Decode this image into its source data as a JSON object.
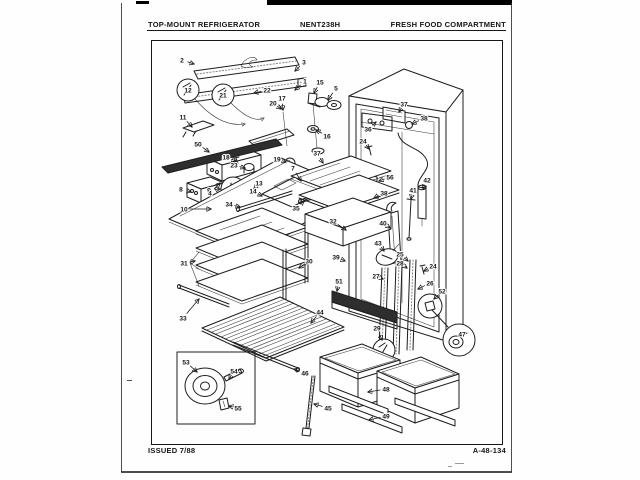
{
  "page": {
    "paper_color": "#fefefe",
    "ink_color": "#1d1d1d"
  },
  "header": {
    "left": "TOP-MOUNT REFRIGERATOR",
    "center": "NENT238H",
    "right": "FRESH FOOD COMPARTMENT"
  },
  "footer": {
    "left": "ISSUED 7/88",
    "right": "A-48-134"
  },
  "diagram": {
    "description": "exploded-parts-view-fresh-food-compartment",
    "callouts": [
      {
        "n": "2",
        "x": 182,
        "y": 60,
        "tx": 194,
        "ty": 64
      },
      {
        "n": "3",
        "x": 304,
        "y": 62,
        "tx": 295,
        "ty": 71
      },
      {
        "n": "1",
        "x": 305,
        "y": 81,
        "tx": 295,
        "ty": 90
      },
      {
        "n": "15",
        "x": 320,
        "y": 82,
        "tx": 314,
        "ty": 93
      },
      {
        "n": "5",
        "x": 336,
        "y": 88,
        "tx": 328,
        "ty": 100
      },
      {
        "n": "12",
        "x": 188,
        "y": 90
      },
      {
        "n": "21",
        "x": 223,
        "y": 95
      },
      {
        "n": "22",
        "x": 267,
        "y": 90,
        "tx": 254,
        "ty": 93
      },
      {
        "n": "17",
        "x": 282,
        "y": 98,
        "tx": 283,
        "ty": 110
      },
      {
        "n": "20",
        "x": 273,
        "y": 103,
        "tx": 281,
        "ty": 109
      },
      {
        "n": "11",
        "x": 183,
        "y": 117,
        "tx": 192,
        "ty": 127
      },
      {
        "n": "16",
        "x": 327,
        "y": 136,
        "tx": 316,
        "ty": 130
      },
      {
        "n": "36",
        "x": 368,
        "y": 129,
        "tx": 376,
        "ty": 122
      },
      {
        "n": "37",
        "x": 404,
        "y": 104,
        "tx": 399,
        "ty": 112
      },
      {
        "n": "38",
        "x": 424,
        "y": 118,
        "tx": 412,
        "ty": 124
      },
      {
        "n": "24",
        "x": 363,
        "y": 141,
        "tx": 369,
        "ty": 149
      },
      {
        "n": "50",
        "x": 198,
        "y": 144,
        "tx": 209,
        "ty": 152
      },
      {
        "n": "37",
        "x": 317,
        "y": 153,
        "tx": 323,
        "ty": 163
      },
      {
        "n": "18",
        "x": 226,
        "y": 157,
        "tx": 236,
        "ty": 161
      },
      {
        "n": "19",
        "x": 277,
        "y": 159,
        "tx": 286,
        "ty": 162
      },
      {
        "n": "23",
        "x": 234,
        "y": 165,
        "tx": 245,
        "ty": 168
      },
      {
        "n": "7",
        "x": 293,
        "y": 168,
        "tx": 301,
        "ty": 181
      },
      {
        "n": "56",
        "x": 390,
        "y": 177,
        "tx": 379,
        "ty": 181
      },
      {
        "n": "42",
        "x": 427,
        "y": 180,
        "tx": 423,
        "ty": 189
      },
      {
        "n": "13",
        "x": 259,
        "y": 183,
        "tx": 254,
        "ty": 189
      },
      {
        "n": "8",
        "x": 181,
        "y": 189,
        "tx": 191,
        "ty": 192
      },
      {
        "n": "9",
        "x": 209,
        "y": 190,
        "tx": 220,
        "ty": 189
      },
      {
        "n": "41",
        "x": 413,
        "y": 190,
        "tx": 411,
        "ty": 199
      },
      {
        "n": "14",
        "x": 253,
        "y": 191,
        "tx": 262,
        "ty": 196
      },
      {
        "n": "4",
        "x": 210,
        "y": 193,
        "tx": 220,
        "ty": 183
      },
      {
        "n": "38",
        "x": 384,
        "y": 193,
        "tx": 374,
        "ty": 198
      },
      {
        "n": "34",
        "x": 229,
        "y": 204,
        "tx": 240,
        "ty": 207
      },
      {
        "n": "35",
        "x": 296,
        "y": 208,
        "tx": 304,
        "ty": 201
      },
      {
        "n": "10",
        "x": 184,
        "y": 209,
        "tx": 211,
        "ty": 209
      },
      {
        "n": "32",
        "x": 333,
        "y": 221,
        "tx": 346,
        "ty": 230
      },
      {
        "n": "40",
        "x": 383,
        "y": 223,
        "tx": 390,
        "ty": 228
      },
      {
        "n": "43",
        "x": 378,
        "y": 243,
        "tx": 384,
        "ty": 251
      },
      {
        "n": "25",
        "x": 400,
        "y": 254,
        "tx": 408,
        "ty": 261
      },
      {
        "n": "39",
        "x": 336,
        "y": 257,
        "tx": 345,
        "ty": 261
      },
      {
        "n": "30",
        "x": 309,
        "y": 261,
        "tx": 299,
        "ty": 268
      },
      {
        "n": "28",
        "x": 400,
        "y": 263,
        "tx": 407,
        "ty": 268
      },
      {
        "n": "31",
        "x": 184,
        "y": 263,
        "tx": 195,
        "ty": 261
      },
      {
        "n": "24",
        "x": 433,
        "y": 266,
        "tx": 424,
        "ty": 271
      },
      {
        "n": "27",
        "x": 376,
        "y": 276,
        "tx": 383,
        "ty": 279
      },
      {
        "n": "51",
        "x": 339,
        "y": 281,
        "tx": 337,
        "ty": 291
      },
      {
        "n": "26",
        "x": 430,
        "y": 283,
        "tx": 418,
        "ty": 289
      },
      {
        "n": "52",
        "x": 442,
        "y": 291,
        "tx": 434,
        "ty": 299
      },
      {
        "n": "44",
        "x": 320,
        "y": 312,
        "tx": 311,
        "ty": 323
      },
      {
        "n": "33",
        "x": 183,
        "y": 318,
        "tx": 199,
        "ty": 299
      },
      {
        "n": "29",
        "x": 377,
        "y": 328,
        "tx": 382,
        "ty": 340
      },
      {
        "n": "47",
        "x": 462,
        "y": 334
      },
      {
        "n": "53",
        "x": 186,
        "y": 362,
        "tx": 197,
        "ty": 372
      },
      {
        "n": "54",
        "x": 234,
        "y": 371,
        "tx": 229,
        "ty": 379
      },
      {
        "n": "46",
        "x": 305,
        "y": 373,
        "tx": 294,
        "ty": 369
      },
      {
        "n": "48",
        "x": 386,
        "y": 389,
        "tx": 368,
        "ty": 392
      },
      {
        "n": "45",
        "x": 328,
        "y": 408,
        "tx": 314,
        "ty": 404
      },
      {
        "n": "55",
        "x": 238,
        "y": 408,
        "tx": 229,
        "ty": 406
      },
      {
        "n": "49",
        "x": 386,
        "y": 416,
        "tx": 369,
        "ty": 420
      }
    ]
  }
}
